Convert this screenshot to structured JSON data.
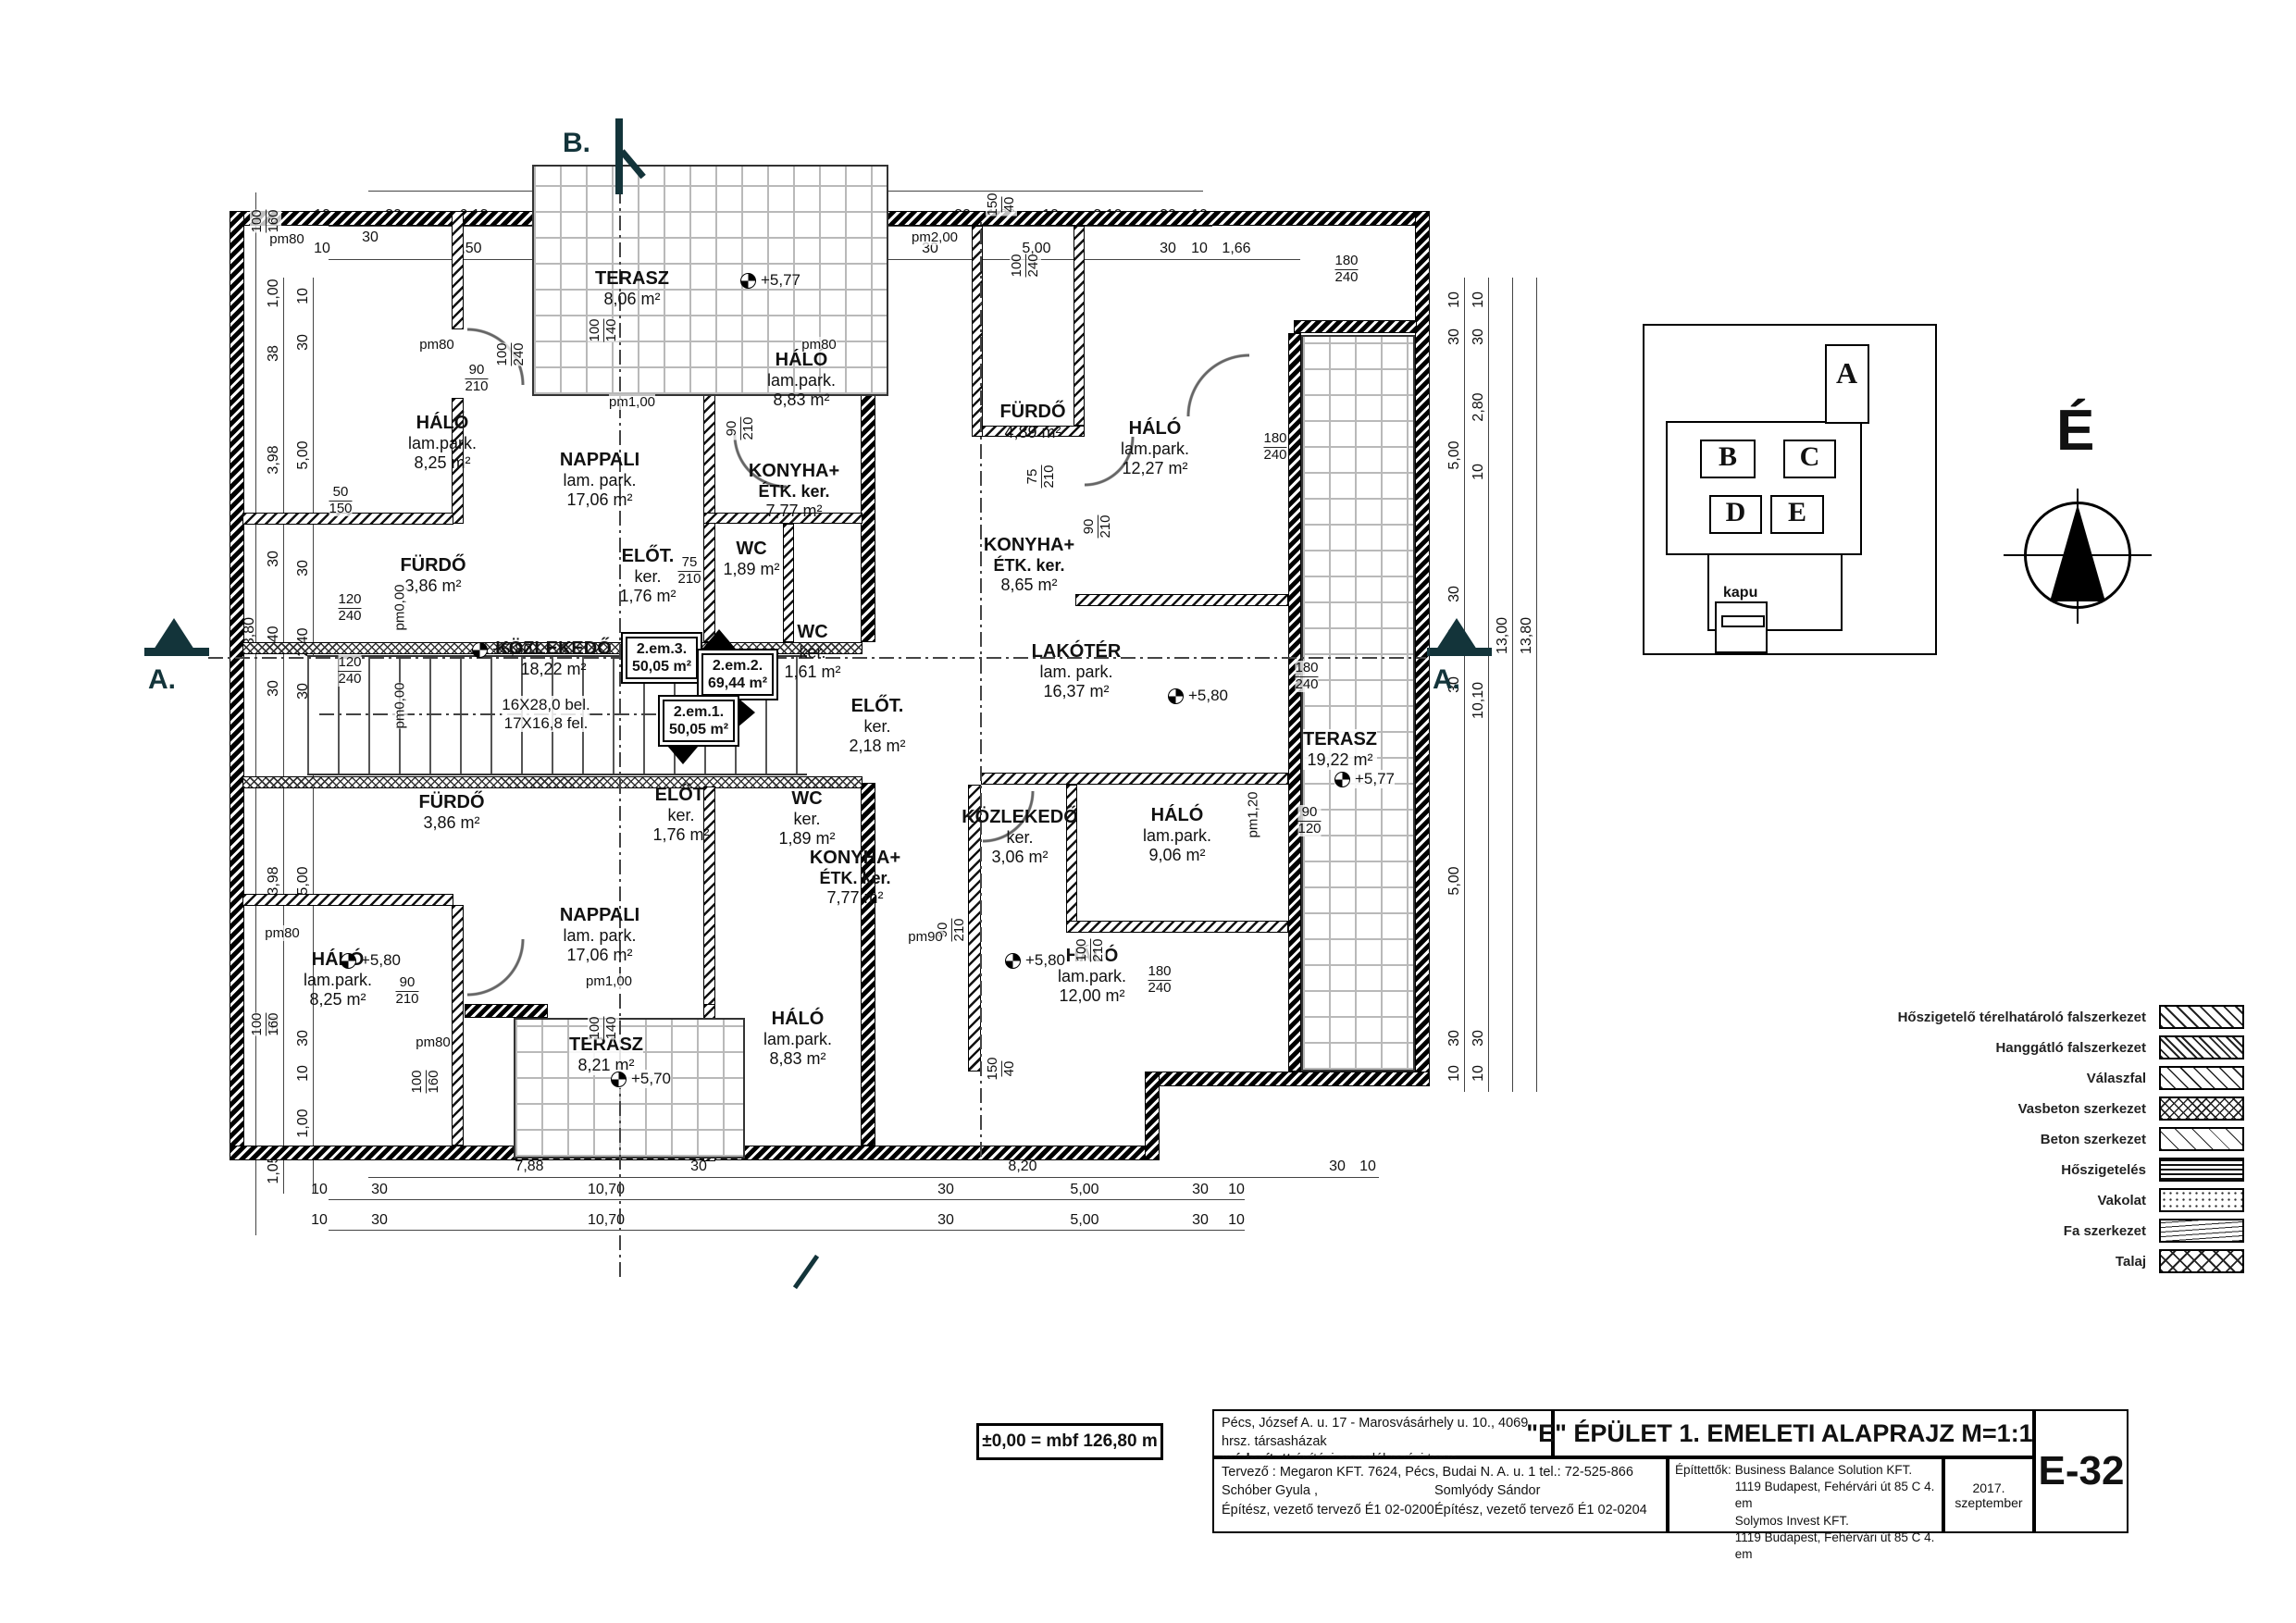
{
  "doc": {
    "proj1": "Pécs, József A. u. 17 - Marosvásárhely u. 10., 4069 hrsz. társasházak",
    "proj2b": "módosított",
    "proj2": " építési engedélyezési terve",
    "title": "\"E\" ÉPÜLET 1. EMELETI ALAPRAJZ M=1:100",
    "designer_line": "Tervező : Megaron KFT. 7624, Pécs, Budai N. A. u. 1  tel.: 72-525-866",
    "designer1": "Schóber Gyula ,",
    "designer2": "Somlyódy Sándor",
    "cred1": "Építész, vezető tervező É1 02-0200",
    "cred2": "Építész, vezető tervező É1 02-0204",
    "clients_label": "Építtettők:",
    "client1": "Business Balance Solution KFT.",
    "client1_addr": "1119 Budapest, Fehérvári út 85 C 4. em",
    "client2": "Solymos Invest KFT.",
    "client2_addr": "1119 Budapest, Fehérvári út 85 C 4. em",
    "date": "2017. szeptember",
    "sheet": "E-32",
    "datum": "±0,00 = mbf 126,80 m"
  },
  "north": {
    "label": "É"
  },
  "section": {
    "a": "A.",
    "b": "B."
  },
  "keyplan": {
    "a": "A",
    "b": "B",
    "c": "C",
    "d": "D",
    "e": "E",
    "gate": "kapu"
  },
  "stair": {
    "l1": "16X28,0 bel.",
    "l2": "17X16,8 fel."
  },
  "units": [
    {
      "id": "2.em.3.",
      "area": "50,05 m²"
    },
    {
      "id": "2.em.2.",
      "area": "69,44 m²"
    },
    {
      "id": "2.em.1.",
      "area": "50,05 m²"
    }
  ],
  "rooms": [
    {
      "name": "HÁLÓ",
      "finish": "lam.park.",
      "area": "8,25 m²"
    },
    {
      "name": "FÜRDŐ",
      "finish": "",
      "area": "3,86 m²"
    },
    {
      "name": "NAPPALI",
      "finish": "lam. park.",
      "area": "17,06 m²"
    },
    {
      "name": "HÁLÓ",
      "finish": "lam.park.",
      "area": "8,83 m²"
    },
    {
      "name": "KONYHA+",
      "finish": "ÉTK. ker.",
      "area": "7,77 m²"
    },
    {
      "name": "WC",
      "finish": "ker.",
      "area": "1,89 m²"
    },
    {
      "name": "ELŐT.",
      "finish": "ker.",
      "area": "1,76 m²"
    },
    {
      "name": "TERASZ",
      "finish": "",
      "area": "8,06 m²"
    },
    {
      "name": "FÜRDŐ",
      "finish": "",
      "area": "4,89 m²"
    },
    {
      "name": "HÁLÓ",
      "finish": "lam.park.",
      "area": "12,27 m²"
    },
    {
      "name": "KONYHA+",
      "finish": "ÉTK. ker.",
      "area": "8,65 m²"
    },
    {
      "name": "LAKÓTÉR",
      "finish": "lam. park.",
      "area": "16,37 m²"
    },
    {
      "name": "WC",
      "finish": "ker.",
      "area": "1,61 m²"
    },
    {
      "name": "ELŐT.",
      "finish": "ker.",
      "area": "2,18 m²"
    },
    {
      "name": "KÖZLEKEDŐ",
      "finish": "",
      "area": "18,22 m²"
    },
    {
      "name": "KÖZLEKEDŐ",
      "finish": "ker.",
      "area": "3,06 m²"
    },
    {
      "name": "HÁLÓ",
      "finish": "lam.park.",
      "area": "9,06 m²"
    },
    {
      "name": "HÁLÓ",
      "finish": "lam.park.",
      "area": "12,00 m²"
    },
    {
      "name": "TERASZ",
      "finish": "",
      "area": "19,22 m²"
    },
    {
      "name": "FÜRDŐ",
      "finish": "",
      "area": "3,86 m²"
    },
    {
      "name": "NAPPALI",
      "finish": "lam. park.",
      "area": "17,06 m²"
    },
    {
      "name": "ELŐT.",
      "finish": "ker.",
      "area": "1,76 m²"
    },
    {
      "name": "WC",
      "finish": "ker.",
      "area": "1,89 m²"
    },
    {
      "name": "KONYHA+",
      "finish": "ÉTK. ker.",
      "area": "7,77 m²"
    },
    {
      "name": "HÁLÓ",
      "finish": "lam.park.",
      "area": "8,83 m²"
    },
    {
      "name": "HÁLÓ",
      "finish": "lam.park.",
      "area": "8,25 m²"
    },
    {
      "name": "TERASZ",
      "finish": "",
      "area": "8,21 m²"
    }
  ],
  "levels": [
    {
      "t": "+5,80"
    },
    {
      "t": "+5,77"
    },
    {
      "t": "+5,80"
    },
    {
      "t": "+5,77"
    },
    {
      "t": "+5,80"
    },
    {
      "t": "+5,80"
    },
    {
      "t": "+5,70"
    }
  ],
  "openings": [
    {
      "a": "90",
      "b": "210"
    },
    {
      "a": "90",
      "b": "210"
    },
    {
      "a": "75",
      "b": "210"
    },
    {
      "a": "100",
      "b": "240"
    },
    {
      "a": "100",
      "b": "140"
    },
    {
      "a": "90",
      "b": "210"
    },
    {
      "a": "180",
      "b": "240"
    },
    {
      "a": "180",
      "b": "240"
    },
    {
      "a": "180",
      "b": "240"
    },
    {
      "a": "90",
      "b": "120"
    },
    {
      "a": "90",
      "b": "210"
    },
    {
      "a": "90",
      "b": "210"
    },
    {
      "a": "100",
      "b": "160"
    },
    {
      "a": "100",
      "b": "160"
    },
    {
      "a": "150",
      "b": "40"
    },
    {
      "a": "150",
      "b": "40"
    },
    {
      "a": "100",
      "b": "160"
    },
    {
      "a": "75",
      "b": "210"
    },
    {
      "a": "100",
      "b": "240"
    },
    {
      "a": "100",
      "b": "210"
    },
    {
      "a": "50",
      "b": "150"
    },
    {
      "a": "120",
      "b": "240"
    },
    {
      "a": "120",
      "b": "240"
    },
    {
      "a": "180",
      "b": "240"
    },
    {
      "a": "100",
      "b": "140"
    }
  ],
  "pms": [
    "pm80",
    "pm80",
    "pm80",
    "pm2,00",
    "pm1,00",
    "pm80",
    "pm1,00",
    "pm90",
    "pm0,00",
    "pm0,00",
    "pm1,20",
    "pm80"
  ],
  "dims": {
    "t1": [
      "16,80"
    ],
    "t2": [
      "10",
      "30",
      "6,13",
      "4,57",
      "30",
      "1,80",
      "10",
      "3,10",
      "30",
      "10"
    ],
    "t2b": [
      "30"
    ],
    "t3": [
      "10",
      "2,50",
      "10",
      "8,10",
      "30",
      "5,00",
      "30",
      "10",
      "1,66"
    ],
    "b1": [
      "7,88",
      "30",
      "8,20",
      "30",
      "10"
    ],
    "b2": [
      "10",
      "30",
      "10,70",
      "30",
      "5,00",
      "30",
      "10"
    ],
    "b3": [
      "10",
      "30",
      "10,70",
      "30",
      "5,00",
      "30",
      "10"
    ],
    "l1": [
      "13,80"
    ],
    "l2": [
      "1,00",
      "38",
      "3,98",
      "30",
      "2,40",
      "30",
      "3,98",
      "30",
      "1,05"
    ],
    "l3": [
      "10",
      "30",
      "5,00",
      "30",
      "2,40",
      "30",
      "5,00",
      "30",
      "10",
      "1,00"
    ],
    "r1": [
      "10",
      "30",
      "5,00",
      "30",
      "2,40",
      "30",
      "5,00",
      "30",
      "10"
    ],
    "r2": [
      "10",
      "30",
      "2,80",
      "10",
      "10,10",
      "30",
      "10"
    ],
    "r3": [
      "13,00"
    ],
    "r4": [
      "13,80"
    ],
    "c1": [
      "2,40"
    ]
  },
  "legend": {
    "items": [
      "Hőszigetelő térelhatároló falszerkezet",
      "Hanggátló falszerkezet",
      "Válaszfal",
      "Vasbeton szerkezet",
      "Beton szerkezet",
      "Hőszigetelés",
      "Vakolat",
      "Fa szerkezet",
      "Talaj"
    ]
  }
}
